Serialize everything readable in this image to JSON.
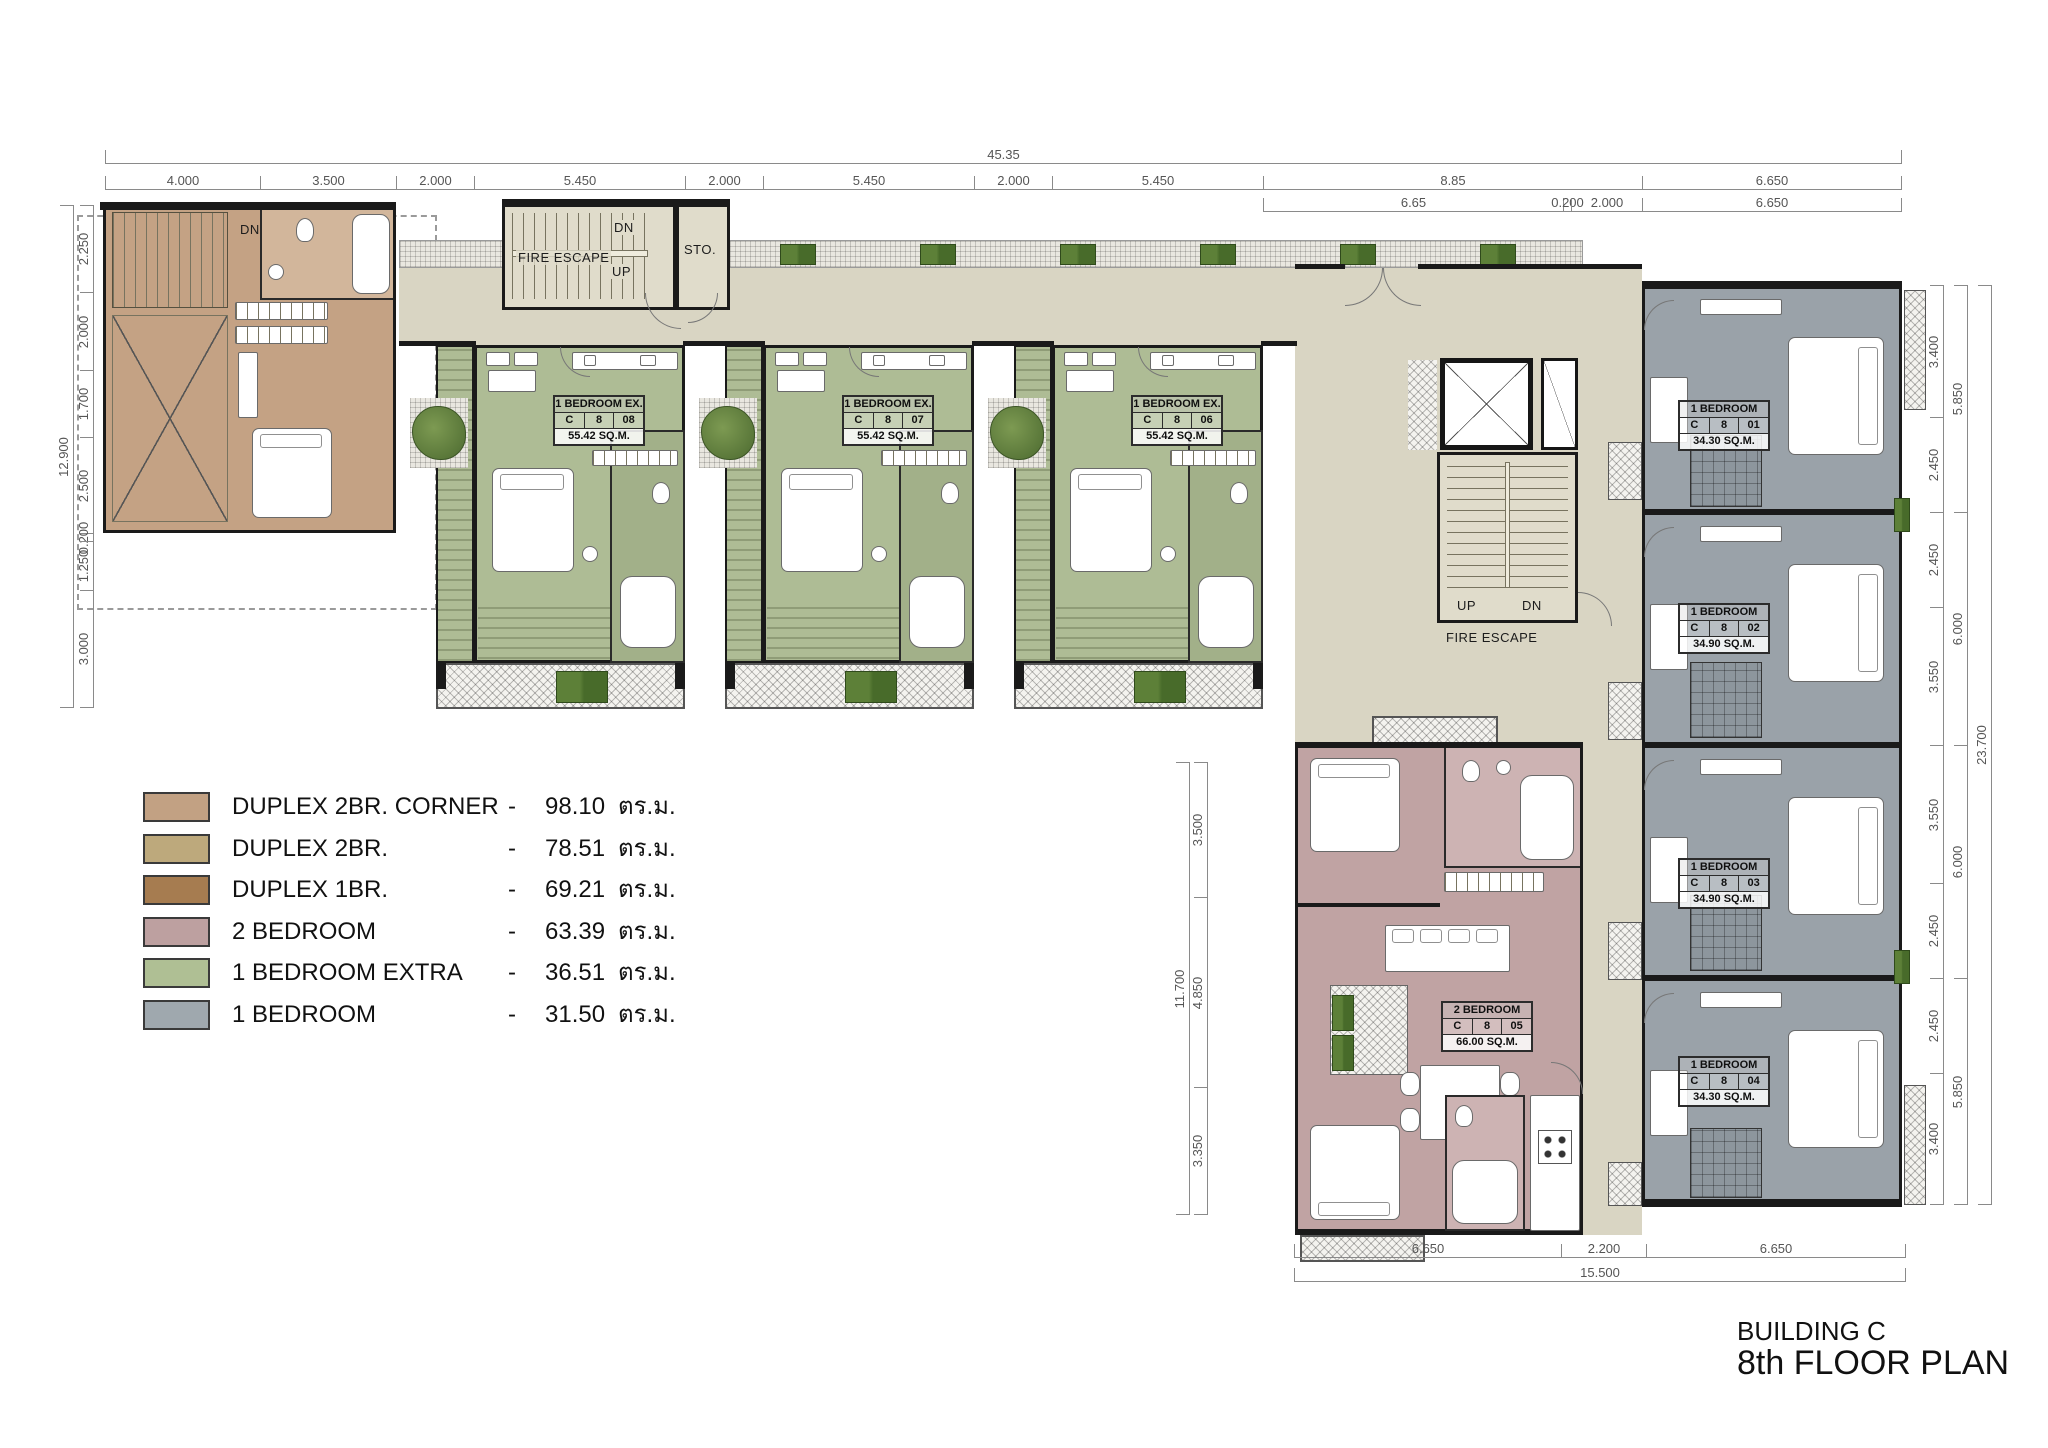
{
  "title": {
    "building": "BUILDING C",
    "floor": "8th FLOOR PLAN"
  },
  "legend": {
    "rows": [
      {
        "label": "DUPLEX 2BR. CORNER",
        "dash": "-",
        "area": "98.10",
        "unit": "ตร.ม.",
        "color": "#c2a183"
      },
      {
        "label": "DUPLEX 2BR.",
        "dash": "-",
        "area": "78.51",
        "unit": "ตร.ม.",
        "color": "#bda97c"
      },
      {
        "label": "DUPLEX 1BR.",
        "dash": "-",
        "area": "69.21",
        "unit": "ตร.ม.",
        "color": "#a67c50"
      },
      {
        "label": "2 BEDROOM",
        "dash": "-",
        "area": "63.39",
        "unit": "ตร.ม.",
        "color": "#bda0a0"
      },
      {
        "label": "1 BEDROOM EXTRA",
        "dash": "-",
        "area": "36.51",
        "unit": "ตร.ม.",
        "color": "#afbf94"
      },
      {
        "label": "1 BEDROOM",
        "dash": "-",
        "area": "31.50",
        "unit": "ตร.ม.",
        "color": "#9fa8ae"
      }
    ]
  },
  "units": {
    "c808": {
      "name": "1 BEDROOM EX.",
      "bld": "C",
      "flr": "8",
      "no": "08",
      "area": "55.42 SQ.M."
    },
    "c807": {
      "name": "1 BEDROOM EX.",
      "bld": "C",
      "flr": "8",
      "no": "07",
      "area": "55.42 SQ.M."
    },
    "c806": {
      "name": "1 BEDROOM EX.",
      "bld": "C",
      "flr": "8",
      "no": "06",
      "area": "55.42 SQ.M."
    },
    "c801": {
      "name": "1 BEDROOM",
      "bld": "C",
      "flr": "8",
      "no": "01",
      "area": "34.30 SQ.M."
    },
    "c802": {
      "name": "1 BEDROOM",
      "bld": "C",
      "flr": "8",
      "no": "02",
      "area": "34.90 SQ.M."
    },
    "c803": {
      "name": "1 BEDROOM",
      "bld": "C",
      "flr": "8",
      "no": "03",
      "area": "34.90 SQ.M."
    },
    "c804": {
      "name": "1 BEDROOM",
      "bld": "C",
      "flr": "8",
      "no": "04",
      "area": "34.30 SQ.M."
    },
    "c805": {
      "name": "2 BEDROOM",
      "bld": "C",
      "flr": "8",
      "no": "05",
      "area": "66.00 SQ.M."
    }
  },
  "labels": {
    "fire_escape": "FIRE ESCAPE",
    "up": "UP",
    "dn": "DN",
    "sto": "STO."
  },
  "dims": {
    "top_total": "45.35",
    "top": [
      "4.000",
      "3.500",
      "2.000",
      "5.450",
      "2.000",
      "5.450",
      "2.000",
      "5.450",
      "8.85",
      "6.650"
    ],
    "top2": [
      "6.65",
      "0.200",
      "2.000",
      "6.650"
    ],
    "left": [
      "2.250",
      "2.000",
      "1.700",
      "2.500",
      "0.200",
      "1.250",
      "3.000"
    ],
    "left_total": "12.900",
    "mid": [
      "3.500",
      "4.850",
      "3.350"
    ],
    "mid_total": "11.700",
    "right": [
      "3.400",
      "2.450",
      "2.450",
      "3.550",
      "3.550",
      "2.450",
      "2.450",
      "3.400"
    ],
    "right2": [
      "5.850",
      "6.000",
      "6.000",
      "5.850"
    ],
    "right_total": "23.700",
    "bottom": [
      "6.650",
      "2.200",
      "6.650"
    ],
    "bottom_total": "15.500"
  }
}
